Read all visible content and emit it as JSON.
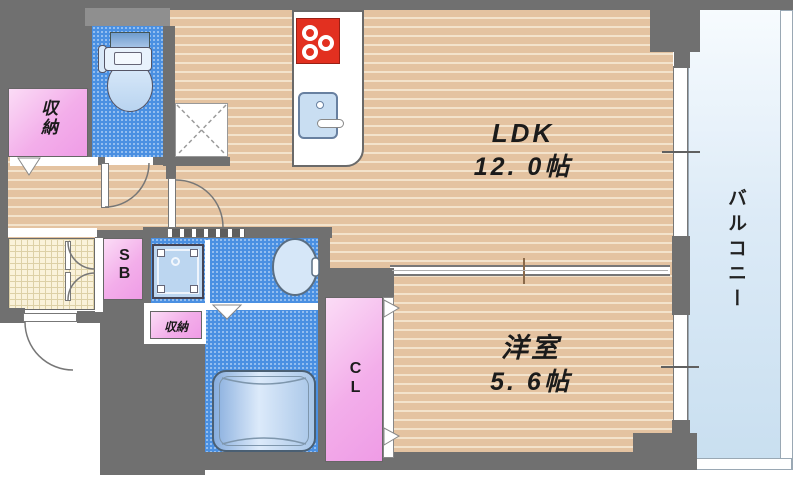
{
  "plan": {
    "title": "1LDK apartment floor plan",
    "ldk": {
      "label": "LDK",
      "area": "12. 0帖"
    },
    "western_room": {
      "label": "洋室",
      "area": "5. 6帖"
    },
    "balcony": {
      "label": "バルコニー"
    },
    "entrance_storage": {
      "label": "収納"
    },
    "hall_storage": {
      "label": "収納"
    },
    "shoe_box": {
      "label": "SB"
    },
    "closet": {
      "label": "CL"
    }
  },
  "colors": {
    "wall": "#707070",
    "wood_floor": "#e4c3a1",
    "wet_area_blue": "#4a90e2",
    "storage_pink": "#f3aeea",
    "balcony_blue": "#cfe3f2",
    "stove_red": "#e23020",
    "tile": "#faf2da"
  }
}
